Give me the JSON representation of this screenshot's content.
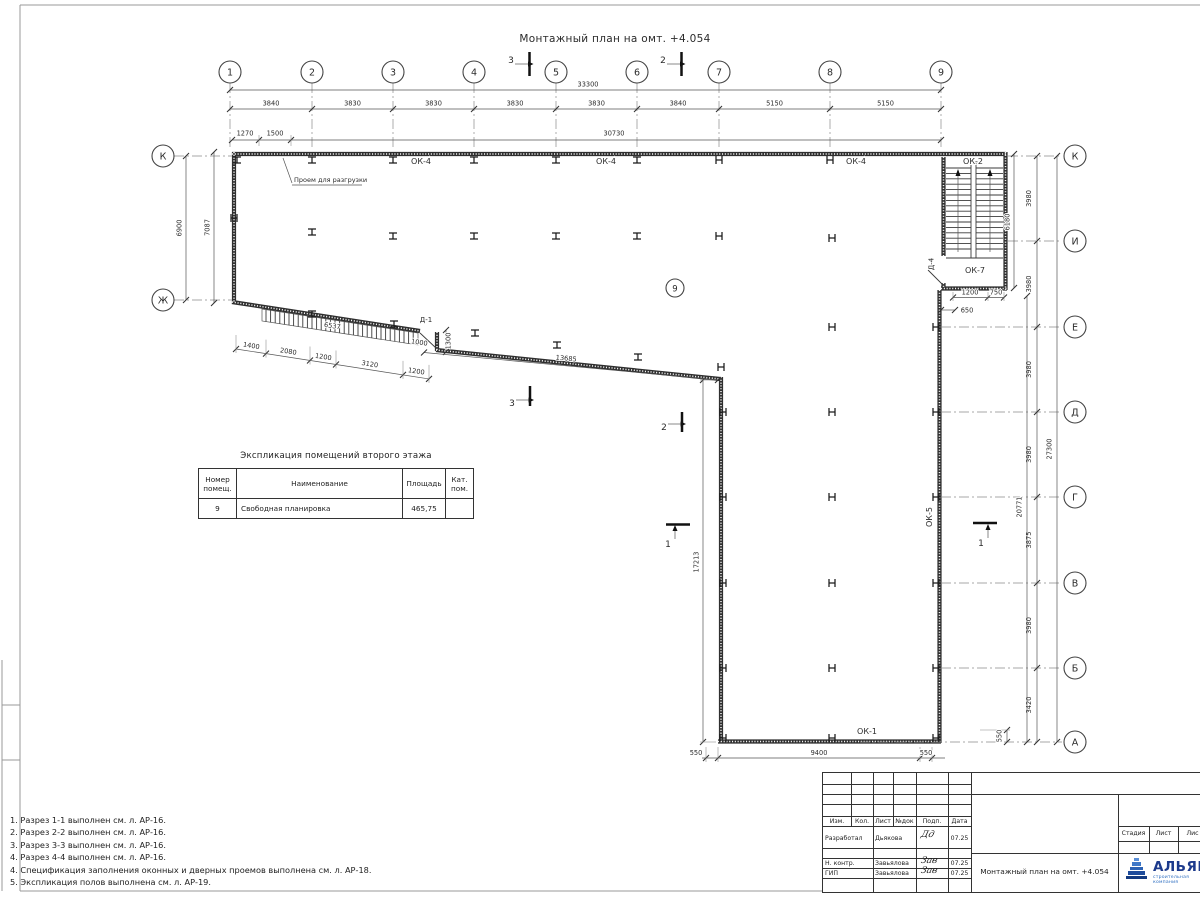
{
  "title": "Монтажный план на омт. +4.054",
  "axes": {
    "cols": [
      "1",
      "2",
      "3",
      "4",
      "5",
      "6",
      "7",
      "8",
      "9"
    ],
    "rows_right": [
      "К",
      "И",
      "Е",
      "Д",
      "Г",
      "В",
      "Б",
      "А"
    ],
    "rows_left": [
      "К",
      "Ж"
    ]
  },
  "dims": {
    "total_top": "33300",
    "col_segments": [
      "3840",
      "3830",
      "3830",
      "3830",
      "3830",
      "3840",
      "5150",
      "5150"
    ],
    "sub_top": [
      "1270",
      "1500",
      "30730"
    ],
    "left": [
      "6900",
      "7087"
    ],
    "right_segments": [
      "3980",
      "3980",
      "3980",
      "3980",
      "3875",
      "3980",
      "3420"
    ],
    "right_total": "27300",
    "right_inner": "20771",
    "stair_height": "6180",
    "stair_bottom": [
      "1200",
      "750",
      "650"
    ],
    "diag_band": "6537",
    "diag_segments": [
      "1400",
      "2080",
      "1200",
      "3120",
      "1200"
    ],
    "door_jog": [
      "1000",
      "1300"
    ],
    "diag_total": "13685",
    "vertical_inner": "17213",
    "bottom": [
      "550",
      "9400",
      "550"
    ],
    "bottom_right": "550"
  },
  "labels": {
    "ok4": "ОК-4",
    "ok2": "ОК-2",
    "ok7": "ОК-7",
    "ok5": "ОК-5",
    "ok1": "ОК-1",
    "d1": "Д-1",
    "d4": "Д-4",
    "opening": "Проем для разгрузки",
    "room": "9"
  },
  "sections": {
    "s1": "1",
    "s2": "2",
    "s3": "3"
  },
  "table": {
    "title": "Экспликация помещений второго этажа",
    "headers": [
      "Номер\nпомещ.",
      "Наименование",
      "Площадь",
      "Кат.\nпом."
    ],
    "rows": [
      [
        "9",
        "Свободная планировка",
        "465,75",
        ""
      ]
    ]
  },
  "notes": [
    "1. Разрез 1-1 выполнен см. л. АР-16.",
    "2. Разрез 2-2 выполнен см. л. АР-16.",
    "3. Разрез 3-3 выполнен см. л. АР-16.",
    "4. Разрез 4-4 выполнен см. л. АР-16.",
    "4. Спецификация заполнения оконных и дверных проемов выполнена см. л. АР-18.",
    "5. Экспликация полов выполнена см. л. АР-19."
  ],
  "titleblock": {
    "rev_headers": [
      "Изм.",
      "Кол.",
      "Лист",
      "№док",
      "Подп.",
      "Дата"
    ],
    "rows": [
      {
        "role": "Разработал",
        "name": "Дьякова",
        "sig": "Дд",
        "date": "07.25"
      },
      {
        "role": "Н. контр.",
        "name": "Завьялова",
        "sig": "Зав",
        "date": "07.25"
      },
      {
        "role": "ГИП",
        "name": "Завьялова",
        "sig": "Зав",
        "date": "07.25"
      }
    ],
    "doc_title": "Монтажный план на омт. +4.054",
    "stage_headers": [
      "Стадия",
      "Лист",
      "Лис"
    ],
    "logo": {
      "name": "АЛЬЯН",
      "sub": "строительная компания"
    }
  },
  "colors": {
    "line": "#3a3a3a",
    "logo_blue": "#1c3a8c",
    "logo_light": "#2f6fc1"
  }
}
